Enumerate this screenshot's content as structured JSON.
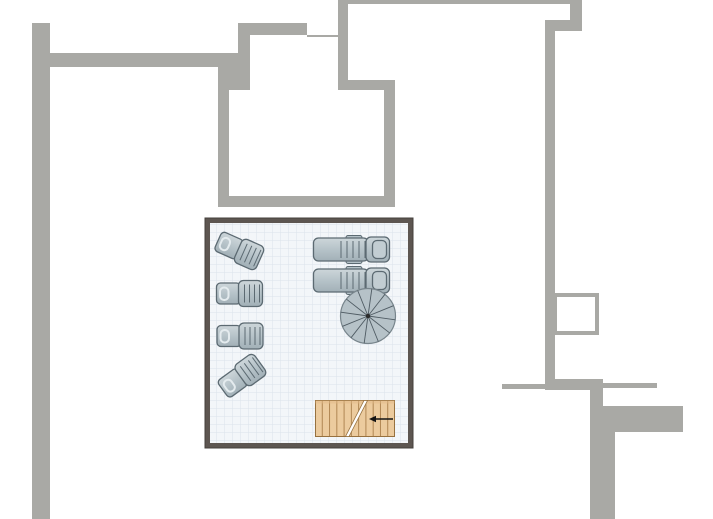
{
  "canvas": {
    "width": 713,
    "height": 519
  },
  "colors": {
    "background": "#ffffff",
    "wall_outer": "#a9a9a5",
    "room_wall": "#5d5651",
    "room_wall_edge": "#45403c",
    "floor": "#f3f6f9",
    "grid_line": "#dbe3eb",
    "furniture_fill": "#b4c1c7",
    "furniture_fill_light": "#cdd6da",
    "furniture_stroke": "#5c6a72",
    "pill_stroke": "#e4ebee",
    "pillow_fill": "#c2cdd2",
    "spiral_fill": "#b6c2c8",
    "spiral_line": "#4f5b63",
    "spiral_rim": "#78858c",
    "spiral_center": "#2b2b2b",
    "wood_fill": "#eccb9e",
    "wood_fill_dark": "#e2b988",
    "wood_line": "#b08653",
    "wood_edge": "#97713f",
    "cut_fill": "#ffffff",
    "arrow": "#141414"
  },
  "walls": [
    {
      "name": "left-exterior-wall",
      "x": 32,
      "y": 23,
      "w": 18,
      "h": 496
    },
    {
      "name": "top-horizontal-wall",
      "x": 50,
      "y": 53,
      "w": 199,
      "h": 14
    },
    {
      "name": "corner-block",
      "x": 218,
      "y": 67,
      "w": 31,
      "h": 23
    },
    {
      "name": "upper-vertical-strip",
      "x": 238,
      "y": 23,
      "w": 12,
      "h": 67
    },
    {
      "name": "upper-horizontal-bar",
      "x": 238,
      "y": 23,
      "w": 69,
      "h": 12
    },
    {
      "name": "thin-wall-segment",
      "x": 307,
      "y": 35,
      "w": 31,
      "h": 2
    },
    {
      "name": "center-vertical-wall",
      "x": 338,
      "y": 0,
      "w": 10,
      "h": 90
    },
    {
      "name": "middle-room-top-wall",
      "x": 338,
      "y": 80,
      "w": 57,
      "h": 10
    },
    {
      "name": "middle-room-left-wall",
      "x": 218,
      "y": 90,
      "w": 11,
      "h": 117
    },
    {
      "name": "middle-room-bottom-wall",
      "x": 218,
      "y": 196,
      "w": 177,
      "h": 11
    },
    {
      "name": "middle-room-right-wall",
      "x": 384,
      "y": 90,
      "w": 11,
      "h": 106
    },
    {
      "name": "top-edge-thin-wall",
      "x": 338,
      "y": 0,
      "w": 232,
      "h": 4
    },
    {
      "name": "top-right-vertical-piece",
      "x": 570,
      "y": 0,
      "w": 12,
      "h": 31
    },
    {
      "name": "top-right-connector",
      "x": 545,
      "y": 20,
      "w": 37,
      "h": 11
    },
    {
      "name": "right-exterior-wall",
      "x": 545,
      "y": 20,
      "w": 10,
      "h": 370
    },
    {
      "name": "right-thin-wall-left",
      "x": 502,
      "y": 384,
      "w": 43,
      "h": 5
    },
    {
      "name": "right-horizontal-bar",
      "x": 545,
      "y": 379,
      "w": 58,
      "h": 11
    },
    {
      "name": "right-thin-wall-right",
      "x": 603,
      "y": 383,
      "w": 54,
      "h": 5
    },
    {
      "name": "lower-right-vertical-neck",
      "x": 590,
      "y": 390,
      "w": 13,
      "h": 19
    },
    {
      "name": "lower-right-vertical-wall",
      "x": 590,
      "y": 409,
      "w": 25,
      "h": 110
    },
    {
      "name": "lower-right-horizontal-bar",
      "x": 590,
      "y": 406,
      "w": 93,
      "h": 26
    }
  ],
  "window_box": {
    "x": 555,
    "y": 295,
    "w": 42,
    "h": 38,
    "border": 4
  },
  "room": {
    "x": 205,
    "y": 218,
    "w": 208,
    "h": 230,
    "wall": 5,
    "grid": 8
  },
  "small_lounger_shape": {
    "w": 47,
    "h": 27,
    "seat": {
      "x": 0.5,
      "y": 3,
      "w": 24,
      "h": 21,
      "rx": 4
    },
    "pill": {
      "x": 4,
      "y": 7.5,
      "w": 8.5,
      "h": 12.5,
      "rx": 4
    },
    "back": {
      "x": 22.5,
      "y": 0.5,
      "w": 24,
      "h": 26,
      "rx": 5
    },
    "slats": {
      "xs": [
        28.5,
        33.5,
        38.5,
        43.5
      ],
      "y1": 4.5,
      "y2": 22.5
    }
  },
  "large_lounger_shape": {
    "w": 77,
    "h": 28,
    "tabs": [
      {
        "x": 33,
        "y": 0,
        "w": 16,
        "h": 5,
        "rx": 2
      },
      {
        "x": 33,
        "y": 23,
        "w": 16,
        "h": 5,
        "rx": 2
      }
    ],
    "body": {
      "x": 0.5,
      "y": 2.5,
      "w": 55,
      "h": 23,
      "rx": 5
    },
    "slats": {
      "xs": [
        28,
        34,
        40,
        46,
        52
      ],
      "y1": 5.5,
      "y2": 22.5
    },
    "head": {
      "x": 53,
      "y": 1.5,
      "w": 23.5,
      "h": 25,
      "rx": 5
    },
    "pillow": {
      "x": 59.5,
      "y": 5,
      "w": 14,
      "h": 18,
      "rx": 4.5
    }
  },
  "small_loungers": [
    {
      "cx": 239,
      "cy": 250,
      "rot": 24
    },
    {
      "cx": 239.5,
      "cy": 293.5,
      "rot": 0
    },
    {
      "cx": 240,
      "cy": 336,
      "rot": 0
    },
    {
      "cx": 241.5,
      "cy": 376.5,
      "rot": -36
    }
  ],
  "large_loungers": [
    {
      "x": 313,
      "y": 235.5
    },
    {
      "x": 313,
      "y": 266.5
    }
  ],
  "spiral_stair": {
    "cx": 368,
    "cy": 316,
    "r": 27.5,
    "sectors": 12,
    "angle_offset": 8
  },
  "wood_stairs": {
    "x": 315,
    "y": 400,
    "w": 80,
    "h": 37,
    "plank_count": 11,
    "cut": {
      "xb1": 345.5,
      "xb2": 349,
      "xt1": 364,
      "xt2": 367.5
    },
    "arrow": {
      "x1": 393,
      "x2": 369,
      "y": 419,
      "head_w": 7,
      "head_h": 6.5
    }
  }
}
